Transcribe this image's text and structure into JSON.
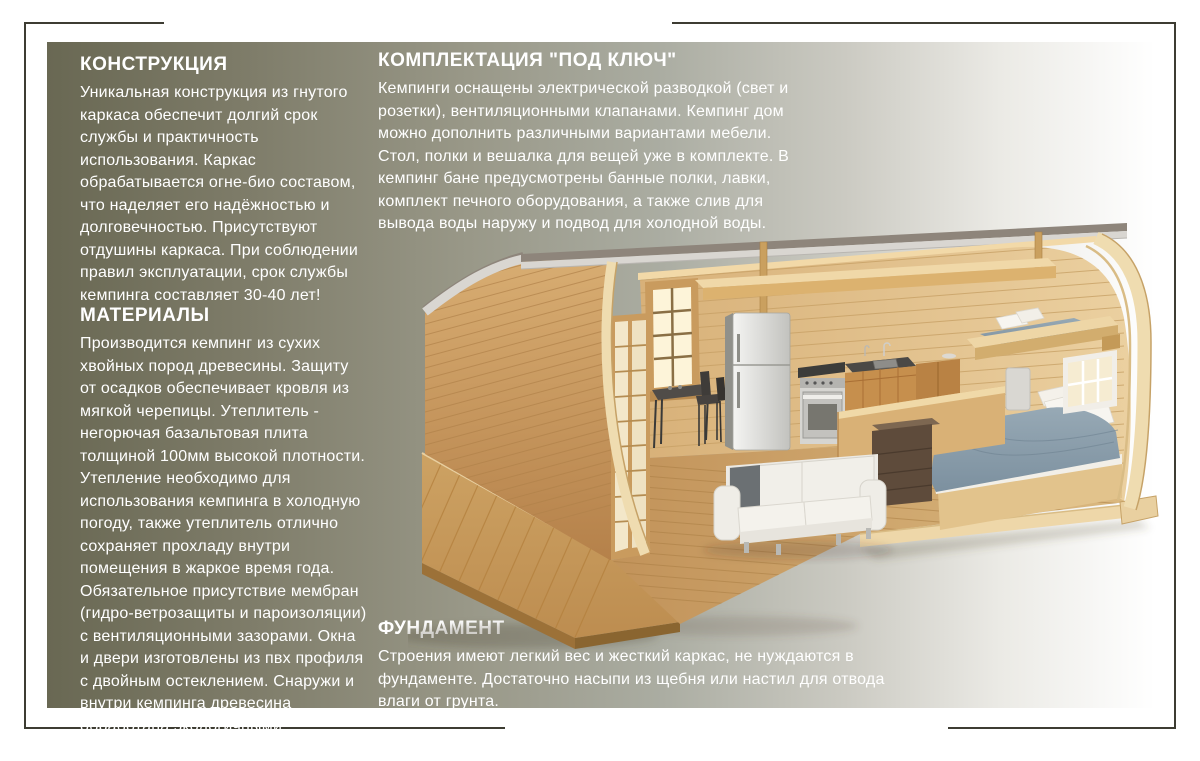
{
  "sections": {
    "construction": {
      "title": "КОНСТРУКЦИЯ",
      "body": "Уникальная конструкция из гнутого каркаса обеспечит долгий срок службы и практичность использования. Каркас обрабатывается огне-био составом, что наделяет его надёжностью и долговечностью. Присутствуют отдушины каркаса. При соблюдении правил эксплуатации, срок службы кемпинга составляет 30-40 лет!"
    },
    "materials": {
      "title": "МАТЕРИАЛЫ",
      "body": "Производится кемпинг из сухих хвойных пород древесины. Защиту от осадков обеспечивает кровля из мягкой черепицы.  Утеплитель - негорючая базальтовая плита толщиной 100мм высокой плотности. Утепление необходимо для использования кемпинга в холодную погоду, также утеплитель отлично сохраняет прохладу внутри помещения в жаркое время года. Обязательное присутствие мембран (гидро-ветрозащиты и пароизоляции) с вентиляционными зазорами. Окна и двери изготовлены из пвх профиля с двойным остеклением. Снаружи и внутри кемпинга древесина обработана экологичными  защитными материалами."
    },
    "equipment": {
      "title": "КОМПЛЕКТАЦИЯ \"ПОД КЛЮЧ\"",
      "body": "Кемпинги оснащены электрической разводкой (свет и розетки), вентиляционными клапанами. Кемпинг дом можно дополнить различными вариантами мебели. Стол, полки и вешалка для вещей уже в комплекте. В кемпинг бане предусмотрены банные полки, лавки, комплект печного оборудования, а также слив для вывода воды наружу и подвод для холодной воды."
    },
    "foundation": {
      "title": "ФУНДАМЕНТ",
      "body": "Строения имеют легкий вес и жесткий каркас, не нуждаются в фундаменте. Достаточно насыпи из щебня или настил для отвода влаги от грунта."
    }
  },
  "illustration": {
    "label": "3D cutaway render of camping house interior"
  },
  "colors": {
    "frame_line": "#3d3c32",
    "text_color": "#ffffff",
    "panel_g0": "#696853",
    "panel_g1": "#7e7c69",
    "panel_g2": "#999888",
    "panel_g3": "#aaaca1",
    "panel_g4": "#cbcac2",
    "panel_g5": "#ebeae5",
    "wood_wall": "#dfbc85",
    "wood_floor": "#c79a5f",
    "bed_duvet": "#8496a4",
    "sofa": "#f0efeb",
    "roof_fascia": "#d9d6d1"
  }
}
